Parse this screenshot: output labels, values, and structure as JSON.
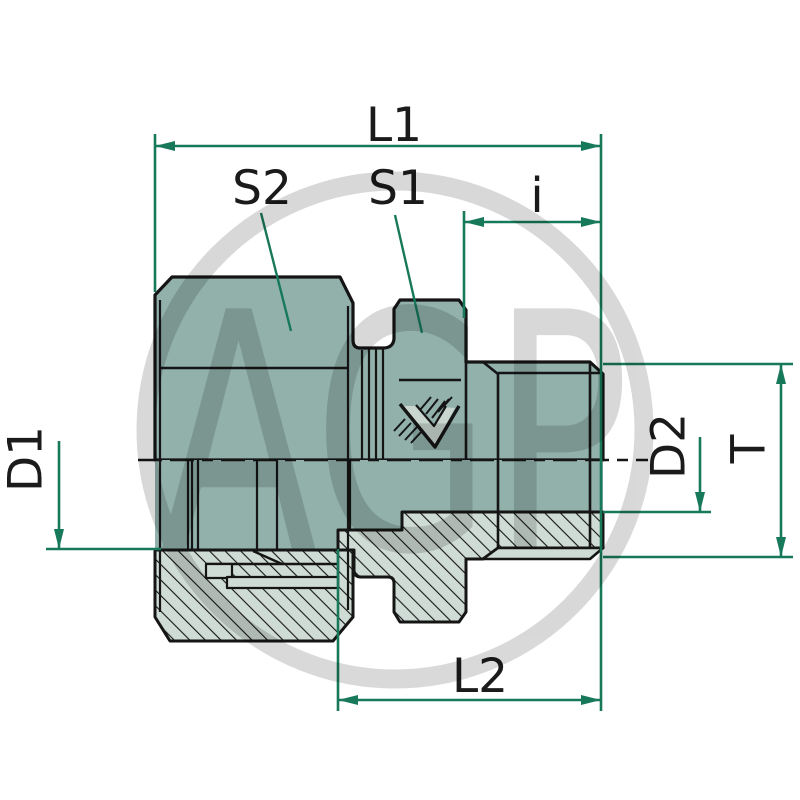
{
  "watermark": {
    "text": "AGP"
  },
  "labels": {
    "l1": "L1",
    "s2": "S2",
    "s1": "S1",
    "i": "i",
    "d1": "D1",
    "d2": "D2",
    "t": "T",
    "l2": "L2"
  },
  "colors": {
    "dimension_green": "#17795a",
    "body_fill": "#92b1ab",
    "section_fill": "#cfdbd5",
    "outline_black": "#151515",
    "watermark_gray": "#d9d9d9",
    "background": "#ffffff"
  }
}
